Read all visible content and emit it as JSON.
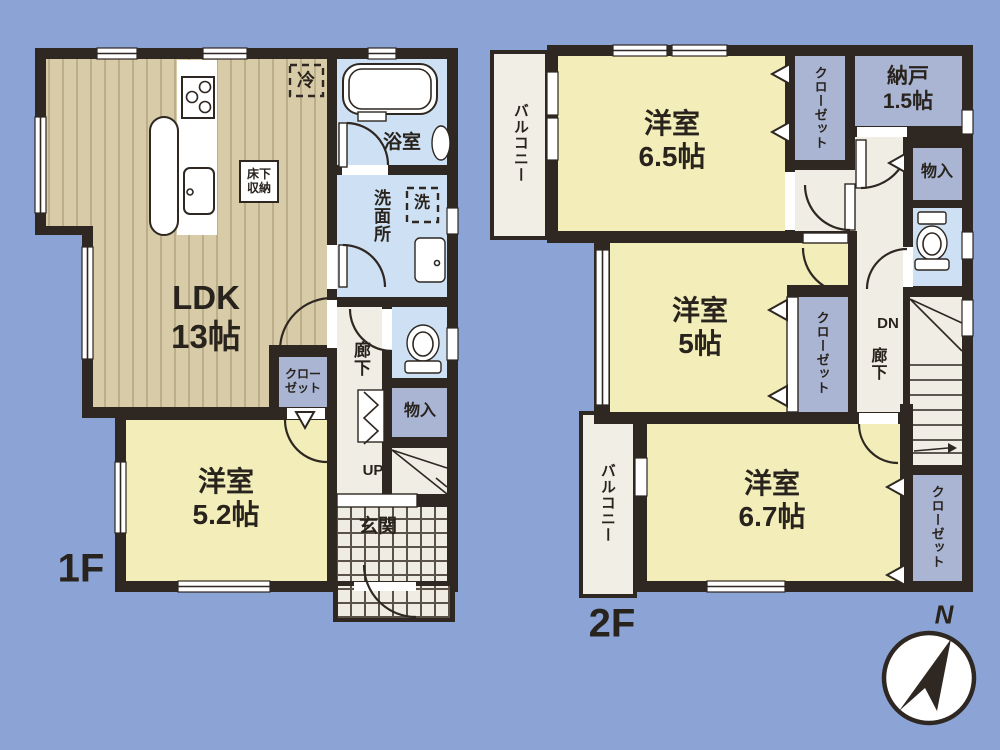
{
  "colors": {
    "background": "#8BA4D5",
    "wall": "#2E2722",
    "wood_floor": "#D8CBA8",
    "room_yellow": "#F2EDB9",
    "wet_area_blue": "#CEE1F4",
    "closet_gray": "#A9B5D3",
    "corridor_cream": "#F0EDE4",
    "text": "#29231E"
  },
  "floor1": {
    "floor_label": "1F",
    "rooms": {
      "ldk": {
        "line1": "LDK",
        "line2": "13帖"
      },
      "western_room": {
        "line1": "洋室",
        "line2": "5.2帖"
      },
      "bath": "浴室",
      "washroom": "洗面所"
    },
    "labels": {
      "fridge": "冷",
      "underfloor_storage_line1": "床下",
      "underfloor_storage_line2": "収納",
      "washer": "洗",
      "hallway": "廊下",
      "closet_line1": "クロー",
      "closet_line2": "ゼット",
      "storage": "物入",
      "stairs_up": "UP",
      "entrance": "玄関"
    }
  },
  "floor2": {
    "floor_label": "2F",
    "rooms": {
      "western_room_65": {
        "line1": "洋室",
        "line2": "6.5帖"
      },
      "western_room_5": {
        "line1": "洋室",
        "line2": "5帖"
      },
      "western_room_67": {
        "line1": "洋室",
        "line2": "6.7帖"
      },
      "storeroom": {
        "line1": "納戸",
        "line2": "1.5帖"
      }
    },
    "labels": {
      "balcony_top": "バルコニー",
      "balcony_bottom": "バルコニー",
      "closet_top": "クローゼット",
      "closet_middle": "クローゼット",
      "closet_bottom": "クローゼット",
      "storage": "物入",
      "hallway": "廊下",
      "stairs_down": "DN"
    }
  },
  "compass": {
    "north": "N"
  }
}
